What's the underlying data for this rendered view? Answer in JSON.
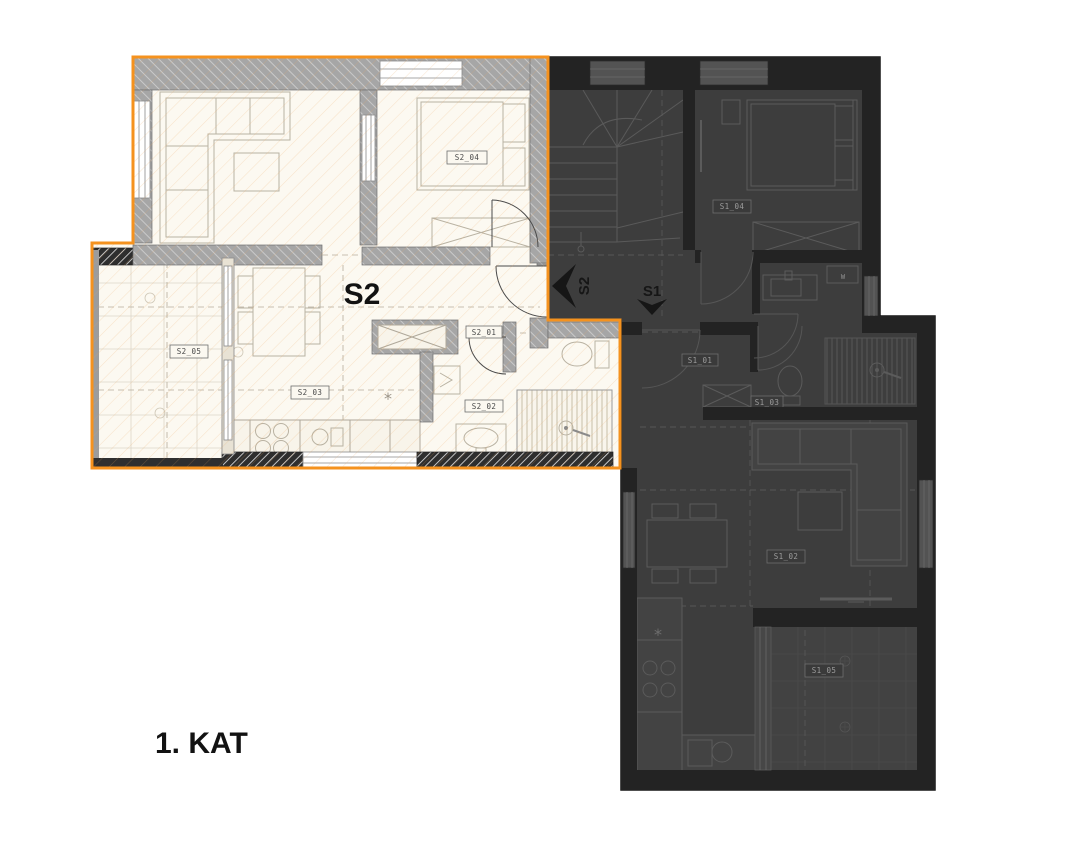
{
  "floor_label": "1. KAT",
  "apartments": {
    "s2": {
      "name": "S2",
      "entrance_marker": "S2",
      "highlight_color": "#F5921E",
      "room_labels": {
        "hall": "S2_01",
        "bathroom": "S2_02",
        "living_kitchen": "S2_03",
        "bedroom": "S2_04",
        "terrace": "S2_05"
      }
    },
    "s1": {
      "name": "S1",
      "entrance_marker": "S1",
      "washer_label": "W",
      "room_labels": {
        "hall": "S1_01",
        "living_kitchen": "S1_02",
        "bathroom": "S1_03",
        "bedroom": "S1_04",
        "terrace": "S1_05"
      }
    }
  }
}
